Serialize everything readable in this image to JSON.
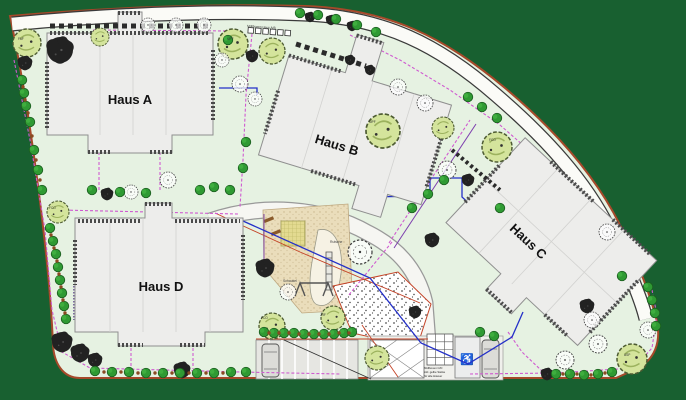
{
  "buildings": [
    {
      "label": "Haus A"
    },
    {
      "label": "Haus B"
    },
    {
      "label": "Haus C"
    },
    {
      "label": "Haus D"
    }
  ],
  "annotations": {
    "street_note": "Müllboxen Haus A/B",
    "bins_note": {
      "line1": "Müllboxen C/D",
      "line2": "inkl. gelbe Säcke",
      "line3": "für alle Häuser"
    },
    "playground": {
      "slide": "Rutsche",
      "swing": "Schaukel"
    }
  },
  "plant_codes": [
    {
      "code": "FAF"
    },
    {
      "code": "MPF"
    },
    {
      "code": "MPF"
    },
    {
      "code": "FCO"
    },
    {
      "code": "FCO"
    },
    {
      "code": "FCO"
    },
    {
      "code": "JRF"
    },
    {
      "code": "ASP"
    }
  ],
  "colors": {
    "background": "#186030",
    "site": "#e6f2e2",
    "road": "#fbfbf7",
    "boundary_line": "#a6492a",
    "building_fill": "#ededeb",
    "tree_canopy": "#d4e49c",
    "shrub_green": "#2f9a33",
    "path_magenta": "#cf5ad0",
    "utility_blue": "#2430c8",
    "accent_purple": "#7d3fae",
    "marking_red": "#c44327",
    "sand": "#e3da90"
  }
}
